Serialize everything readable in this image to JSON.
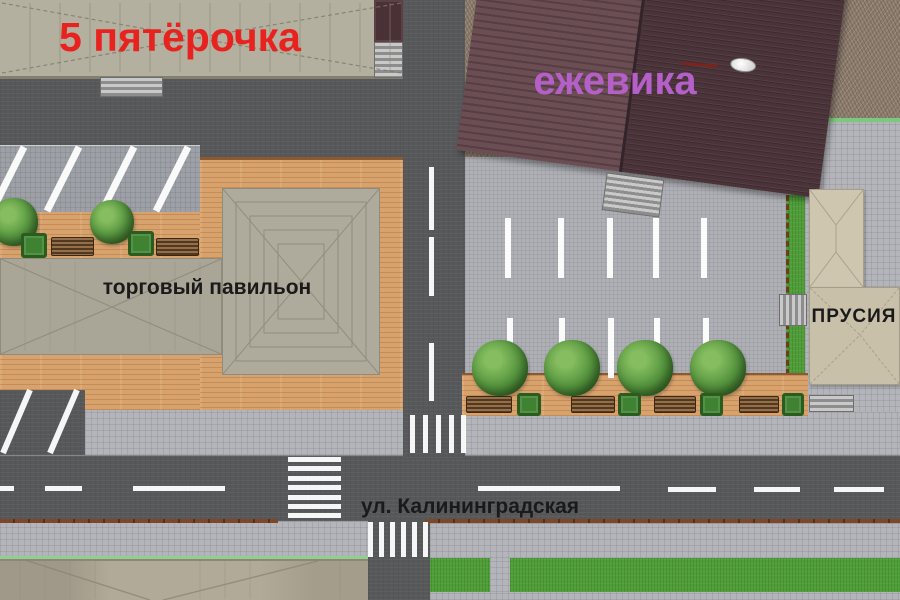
{
  "title": "Site plan — street-level master plan render",
  "labels": {
    "store_left": "5 пятёрочка",
    "store_right": "ежевика",
    "pavilion": "торговый павильон",
    "building_right": "ПРУСИЯ",
    "street": "ул. Калининградская"
  },
  "colors": {
    "accent_red": "#e8231f",
    "accent_purple": "#b55fc8",
    "label_black": "#1a1a1a",
    "road": "#56585a",
    "sidewalk": "#b3b5bb",
    "parking": "#aeb0b6",
    "parking_dark": "#9da0a6",
    "deck": "#d8a26c",
    "gravel": "#8d7d6f",
    "grass": "#4f9e39",
    "roof_light": "#b4b09f",
    "roof_pavilion": "#a9a697",
    "roof_dark_left": "#6b4e54",
    "roof_dark_right": "#4a343a",
    "roof_beige": "#cfc6b0",
    "roof_bottom": "#b2aa98",
    "marking_white": "#ffffff",
    "bench_brown": "#6f4a2a",
    "planter_green": "#3f8232",
    "curb_brown": "#7c4828"
  }
}
